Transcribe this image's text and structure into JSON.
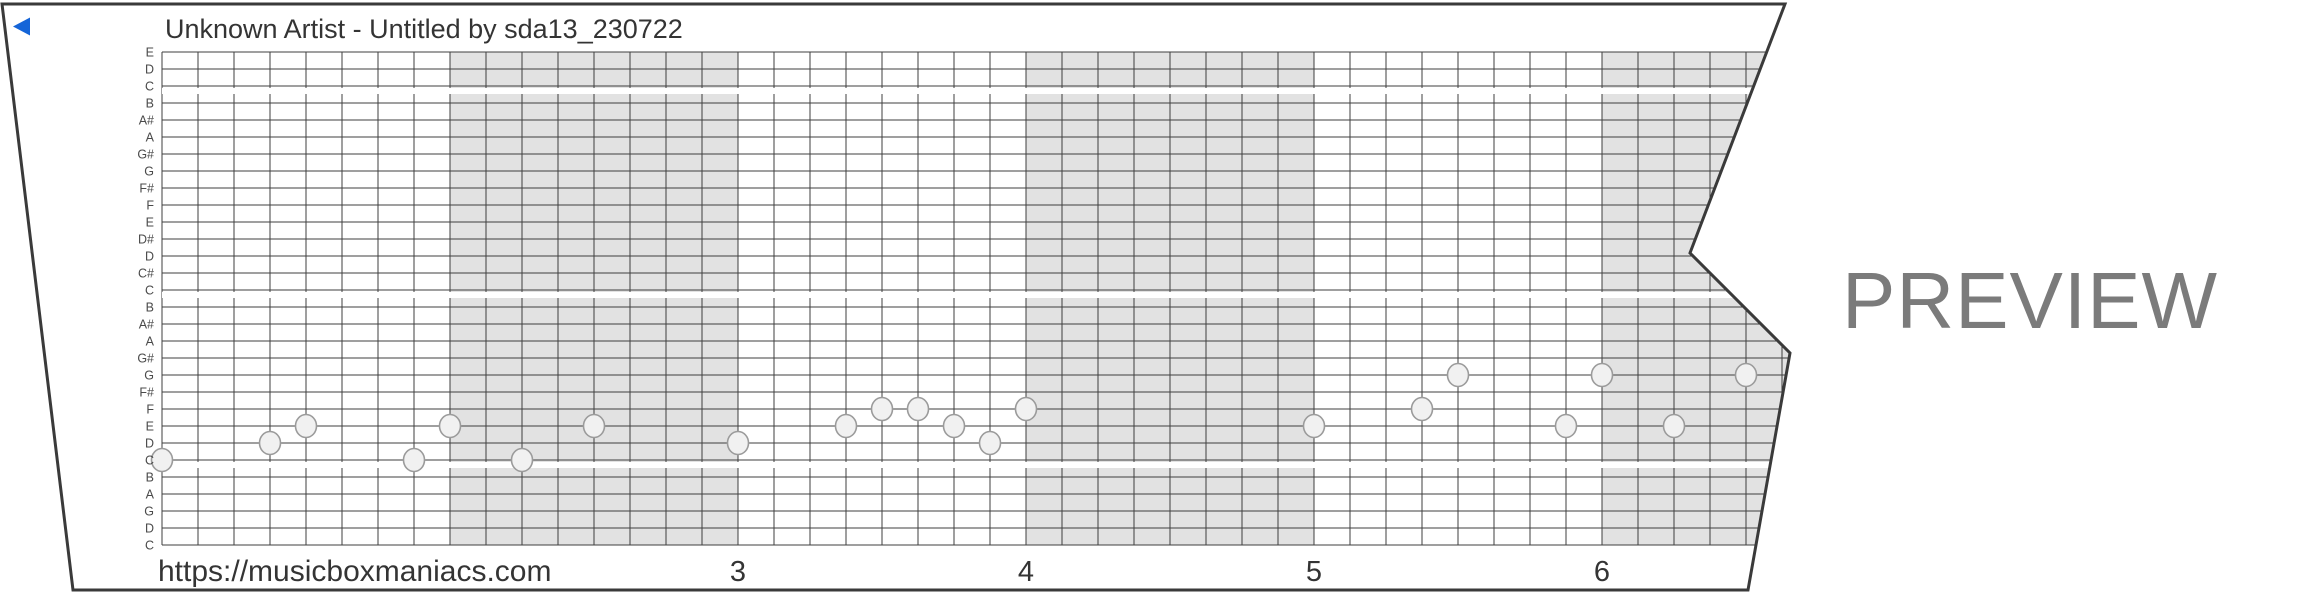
{
  "strip": {
    "title": "Unknown Artist - Untitled by sda13_230722",
    "footer_url": "https://musicboxmaniacs.com",
    "watermark": "PREVIEW",
    "pitch_labels": [
      "E",
      "D",
      "C",
      "B",
      "A#",
      "A",
      "G#",
      "G",
      "F#",
      "F",
      "E",
      "D#",
      "D",
      "C#",
      "C",
      "B",
      "A#",
      "A",
      "G#",
      "G",
      "F#",
      "F",
      "E",
      "D",
      "C",
      "B",
      "A",
      "G",
      "D",
      "C"
    ],
    "octave_break_rows": [
      3,
      15,
      25
    ],
    "measure_numbers": [
      {
        "label": "3",
        "measure": 3
      },
      {
        "label": "4",
        "measure": 4
      },
      {
        "label": "5",
        "measure": 5
      },
      {
        "label": "6",
        "measure": 6
      }
    ],
    "notes": [
      {
        "beat": 0,
        "row": 25,
        "pitch": "C"
      },
      {
        "beat": 3,
        "row": 24,
        "pitch": "D"
      },
      {
        "beat": 4,
        "row": 23,
        "pitch": "E"
      },
      {
        "beat": 7,
        "row": 25,
        "pitch": "C"
      },
      {
        "beat": 8,
        "row": 23,
        "pitch": "E"
      },
      {
        "beat": 10,
        "row": 25,
        "pitch": "C"
      },
      {
        "beat": 12,
        "row": 23,
        "pitch": "E"
      },
      {
        "beat": 16,
        "row": 24,
        "pitch": "D"
      },
      {
        "beat": 19,
        "row": 23,
        "pitch": "E"
      },
      {
        "beat": 20,
        "row": 22,
        "pitch": "F"
      },
      {
        "beat": 21,
        "row": 22,
        "pitch": "F"
      },
      {
        "beat": 22,
        "row": 23,
        "pitch": "E"
      },
      {
        "beat": 23,
        "row": 24,
        "pitch": "D"
      },
      {
        "beat": 24,
        "row": 22,
        "pitch": "F"
      },
      {
        "beat": 32,
        "row": 23,
        "pitch": "E"
      },
      {
        "beat": 35,
        "row": 22,
        "pitch": "F"
      },
      {
        "beat": 36,
        "row": 20,
        "pitch": "G"
      },
      {
        "beat": 39,
        "row": 23,
        "pitch": "E"
      },
      {
        "beat": 40,
        "row": 20,
        "pitch": "G"
      },
      {
        "beat": 42,
        "row": 23,
        "pitch": "E"
      },
      {
        "beat": 44,
        "row": 20,
        "pitch": "G"
      }
    ],
    "colors": {
      "marker_blue": "#1565d8",
      "measure_shade": "#e2e2e2",
      "grid_line": "#3f3f3f",
      "strip_border": "#3a3a3a",
      "note_fill": "#f1f1f1",
      "note_stroke": "#9b9b9b",
      "text_dark": "#343434",
      "label_gray": "#4a4a4a",
      "watermark_gray": "#7b7b7b"
    }
  }
}
